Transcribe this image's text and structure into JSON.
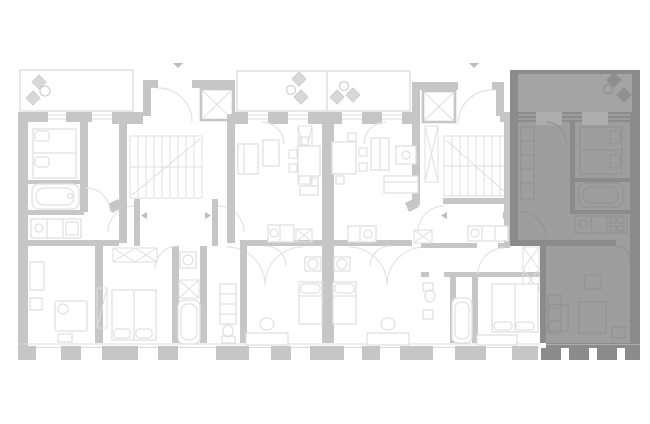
{
  "page": {
    "background": "#ffffff"
  },
  "colors": {
    "background": "#ffffff",
    "wall": "#c6c6c6",
    "line": "#dcdcdc",
    "balcony_line": "#dedede",
    "furniture": "#e0e0e0",
    "arc": "#e3e3e3",
    "grid": "#dfdfdf",
    "plant": "#d8d8d8",
    "plant_stroke": "#cfcfcf",
    "marker": "#bdbdbd",
    "selected_wall": "#8b8b8b",
    "selected_floor": "#9e9e9e",
    "selected_balcony": "#a4a4a4",
    "selected_window": "#adadad",
    "selected_furniture": "#939393",
    "selected_plant": "#8f8f8f"
  },
  "floor_plan": {
    "units": [
      {
        "id": "apartment-left",
        "highlighted": false
      },
      {
        "id": "apartment-center-left",
        "highlighted": false
      },
      {
        "id": "apartment-center-right",
        "highlighted": false
      },
      {
        "id": "apartment-right",
        "highlighted": false
      },
      {
        "id": "apartment-far-right",
        "highlighted": true,
        "highlight_color": "#8b8b8b"
      }
    ],
    "balconies": 4,
    "stair_cores": 2,
    "elevators": 2,
    "entrance_arrows_top": 2,
    "landing_arrows": 4
  }
}
